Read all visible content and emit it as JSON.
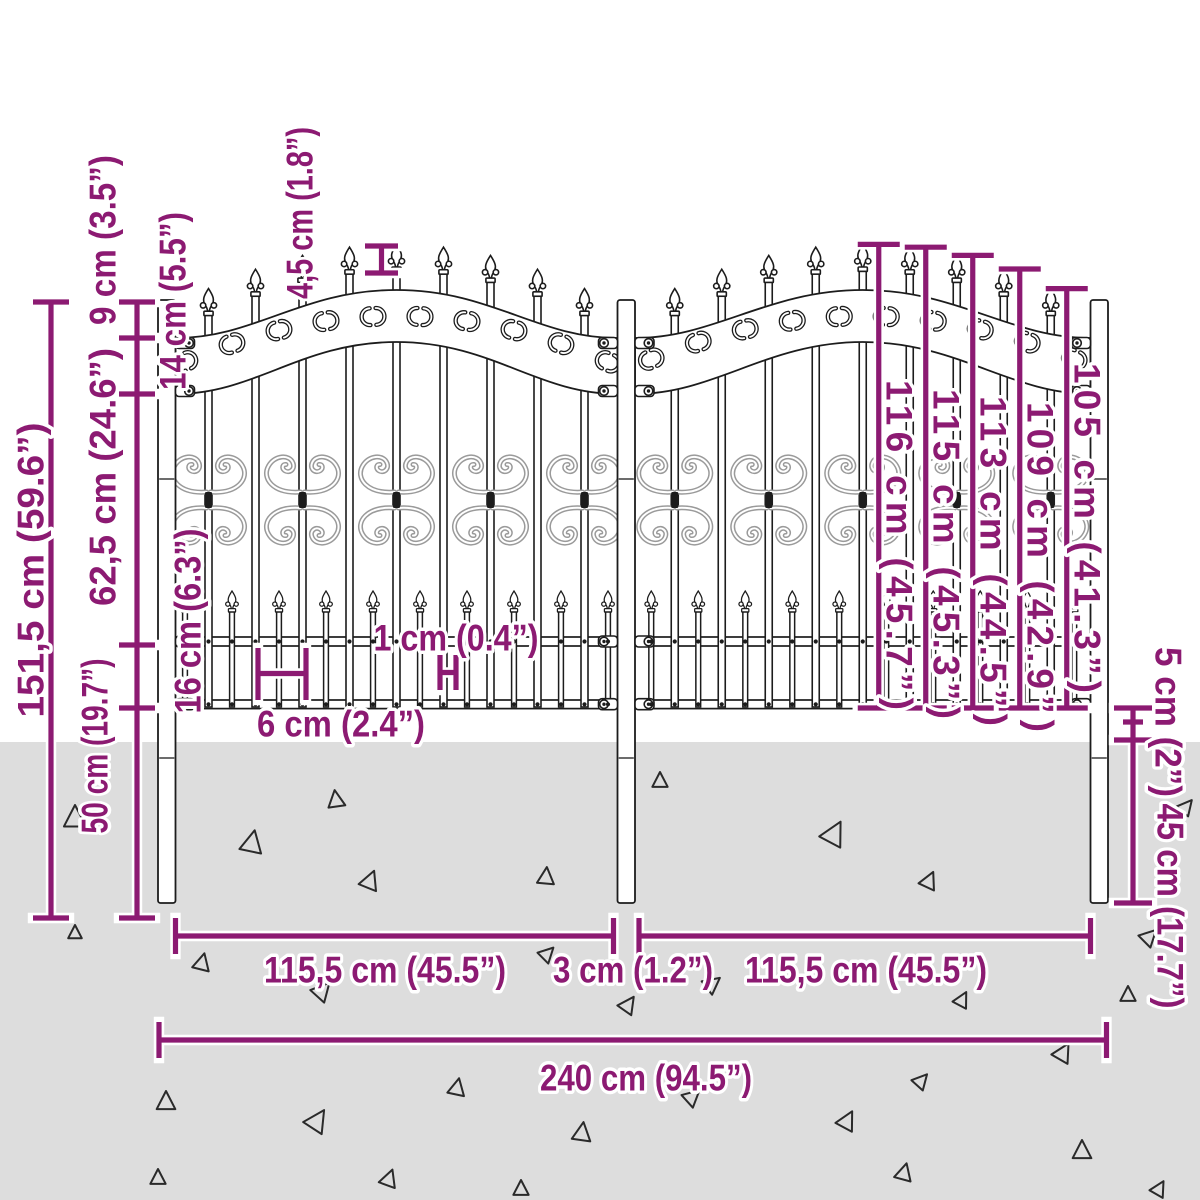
{
  "diagram": {
    "type": "product dimension drawing",
    "subject": "decorative metal garden fence with spear-top arched panels and ground spikes",
    "unit_system": "centimetres with inches in parentheses"
  },
  "colors": {
    "dimension": "#8C1A72",
    "ink": "#1c1c1c",
    "scroll_gray": "#9a9a9a",
    "ground": "#dddddd",
    "background": "#ffffff"
  },
  "annotations": {
    "total_height": "151,5 cm (59.6”)",
    "top_section": "9 cm (3.5”)",
    "arch_band": "14 cm (5.5”)",
    "mid_section": "62,5 cm (24.6”)",
    "rail_gap": "16 cm (6.3”)",
    "ground_section": "50 cm (19.7”)",
    "spear_pitch": "4,5 cm (1.8”)",
    "bar_heights": [
      "116 cm (45.7”)",
      "115 cm (45.3”)",
      "113 cm (44.5”)",
      "109 cm (42.9”)",
      "105 cm (41.3”)"
    ],
    "bar_thickness": "1 cm (0.4”)",
    "picket_spacing": "6 cm (2.4”)",
    "rail_to_ground": "5 cm (2”)",
    "spike_depth": "45 cm (17.7”)",
    "panel_width_left": "115,5 cm (45.5”)",
    "post_width": "3 cm (1.2”)",
    "panel_width_right": "115,5 cm (45.5”)",
    "total_width": "240 cm (94.5”)"
  }
}
